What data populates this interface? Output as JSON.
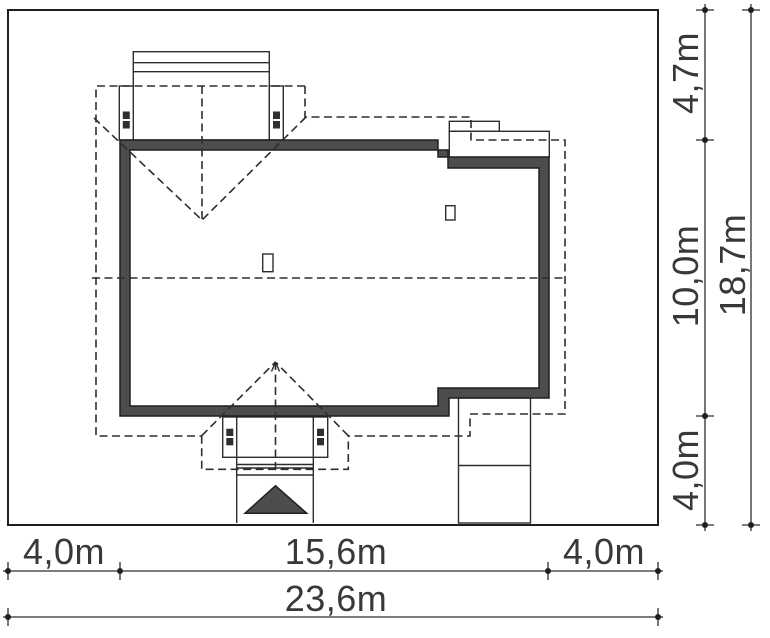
{
  "drawing": {
    "kind": "house-site-plan",
    "dimensions": {
      "bottom_segments": [
        "4,0m",
        "15,6m",
        "4,0m"
      ],
      "bottom_total": "23,6m",
      "right_segments": [
        "4,7m",
        "10,0m",
        "4,0m"
      ],
      "right_total": "18,7m"
    },
    "colors": {
      "wall_fill": "#4d4d4d",
      "line": "#2e2e2e",
      "background": "#ffffff"
    }
  }
}
